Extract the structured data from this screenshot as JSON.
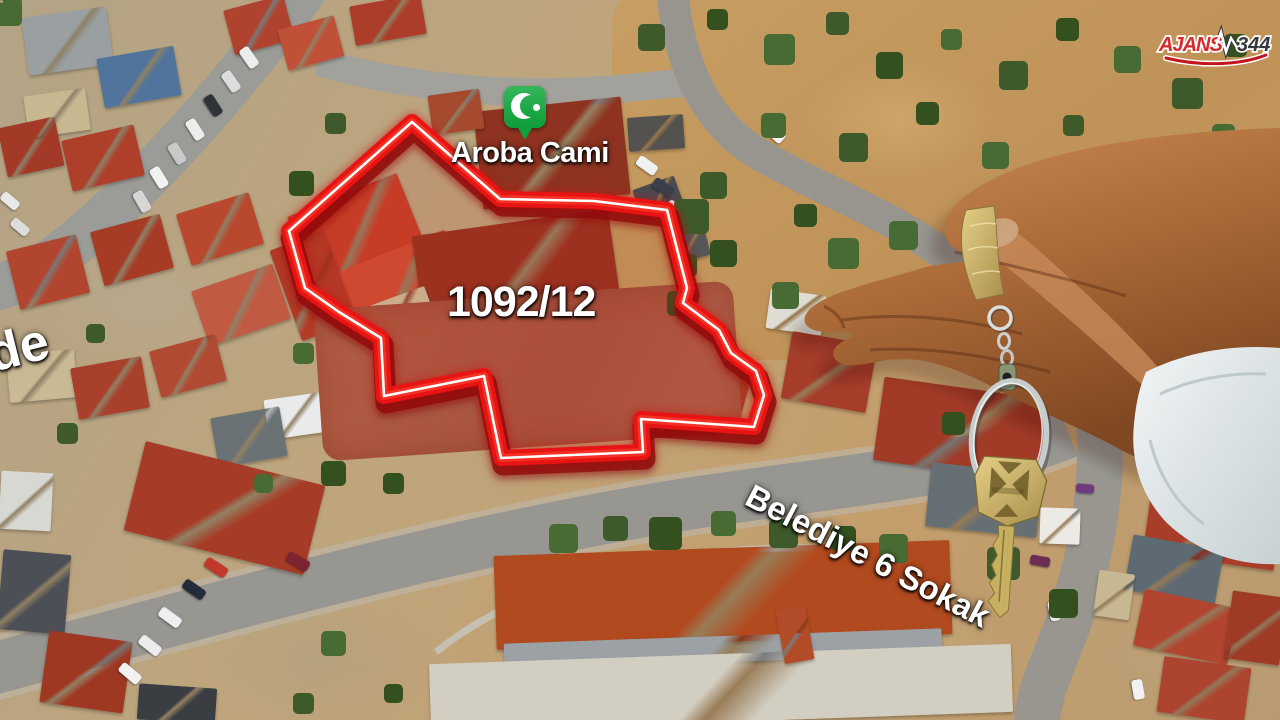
{
  "labels": {
    "parcel_number": "1092/12",
    "poi_name": "Aroba Cami",
    "street_name": "Belediye 6 Sokak",
    "street_name_partial": "de"
  },
  "marker": {
    "type": "mosque-pin",
    "color": "#14a440",
    "symbol": "crescent"
  },
  "parcel": {
    "outline_color": "#e81313",
    "outline_inner_line": "#ffffff"
  },
  "brand": {
    "left": "AJANS",
    "right": "344",
    "accent_color": "#d7282c",
    "dark_color": "#35383c"
  }
}
